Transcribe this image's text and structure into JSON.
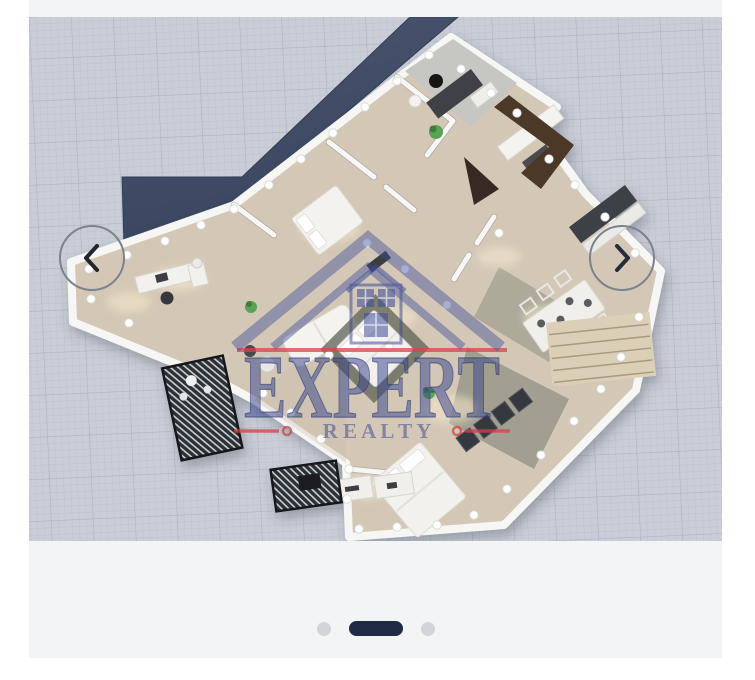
{
  "carousel": {
    "prev_label": "Previous photo",
    "next_label": "Next photo",
    "pagination": {
      "total_slides": 3,
      "active_slide": 2
    }
  },
  "watermark": {
    "brand_top": "EXPERT",
    "brand_bottom": "R E A L T Y"
  },
  "photo": {
    "description": "3D isometric floor plan render of an apartment on grid-paper background with dark terrace band, wood floors, white walls, furniture and ceiling lights",
    "colors": {
      "grid_bg": "#c9cdd6",
      "grid_line": "#aab1c0",
      "terrace_navy": "#424e67",
      "floor_wood": "#d3c8b6",
      "wall_white": "#f6f6f4",
      "bathroom_tile": "#c6c7c3",
      "dark_fixture": "#3c3e42",
      "plant_green": "#5aa355",
      "watermark_navy": "#3a478f",
      "watermark_red": "#d6454e"
    }
  },
  "theme": {
    "page_bg": "#ffffff",
    "card_bg": "#f3f4f6",
    "active_dot": "#1f2a44",
    "inactive_dot": "#d2d4d9",
    "arrow_ring": "#7d828c",
    "arrow_glyph": "#23262e"
  }
}
